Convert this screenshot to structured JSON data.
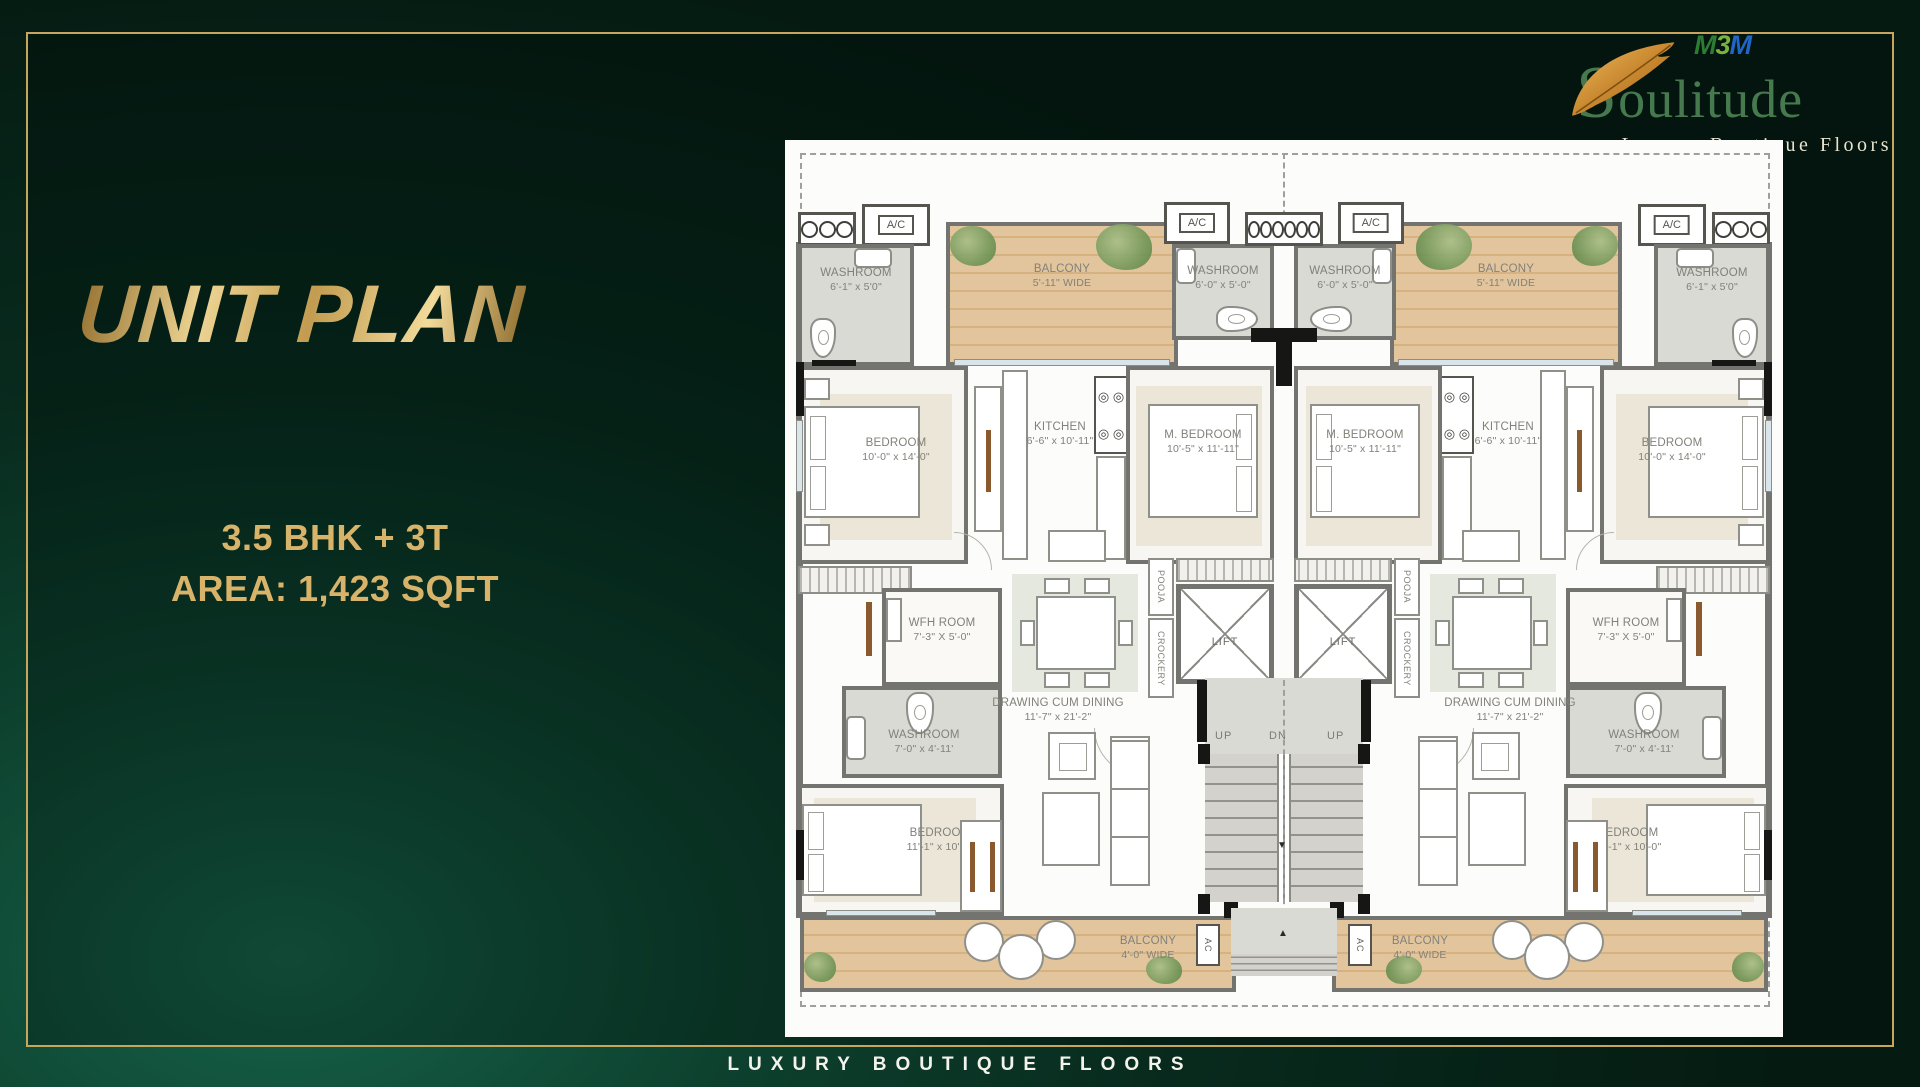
{
  "page": {
    "heading": "UNIT PLAN",
    "line1": "3.5 BHK + 3T",
    "line2": "AREA: 1,423 SQFT",
    "footer": "LUXURY BOUTIQUE FLOORS"
  },
  "logo": {
    "m1": "M",
    "d3": "3",
    "m2": "M",
    "name_initial": "S",
    "name_rest": "oulitude",
    "tagline": "Luxury Boutique Floors"
  },
  "colors": {
    "gold": "#c6a55e",
    "background_green": "#0a3525",
    "logo_green": "#47794f",
    "balcony_wood": "#e3c59d"
  },
  "plan": {
    "labels": {
      "washroom_corner": {
        "name": "WASHROOM",
        "dims": "6'-1\" x 5'0\""
      },
      "balcony_top": {
        "name": "BALCONY",
        "dims": "5'-11\" WIDE"
      },
      "washroom_center": {
        "name": "WASHROOM",
        "dims": "6'-0\" x 5'-0\""
      },
      "bedroom_top": {
        "name": "BEDROOM",
        "dims": "10'-0\" x 14'-0\""
      },
      "kitchen": {
        "name": "KITCHEN",
        "dims": "6'-6\" x 10'-11\""
      },
      "m_bedroom": {
        "name": "M. BEDROOM",
        "dims": "10'-5\" x 11'-11\""
      },
      "wfh_room": {
        "name": "WFH ROOM",
        "dims": "7'-3\" X 5'-0\""
      },
      "washroom_mid": {
        "name": "WASHROOM",
        "dims": "7'-0\" x 4'-11'"
      },
      "drawing_dining": {
        "name": "DRAWING CUM DINING",
        "dims": "11'-7\" x 21'-2\""
      },
      "bedroom_bottom": {
        "name": "BEDROOM",
        "dims": "11'-1\" x 10'-0\""
      },
      "balcony_bottom": {
        "name": "BALCONY",
        "dims": "4'-0\" WIDE"
      },
      "lift": "LIFT",
      "pooja": "POOJA",
      "crockery": "CROCKERY",
      "ac_unit": "A/C",
      "ac_small": "AC",
      "up": "UP",
      "dn": "DN"
    }
  }
}
